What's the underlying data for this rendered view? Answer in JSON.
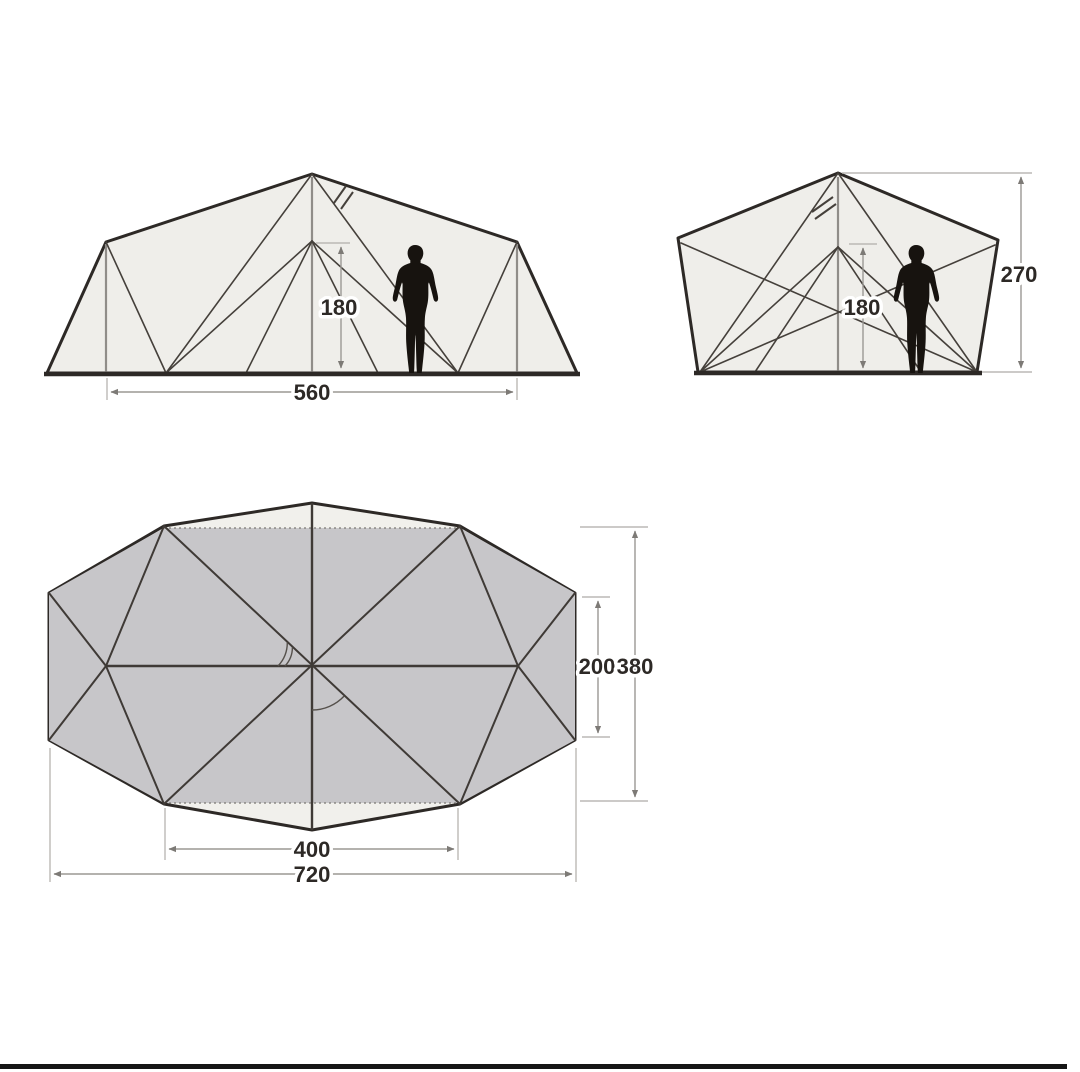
{
  "page": {
    "background": "#ffffff",
    "bottom_bar_color": "#151515"
  },
  "colors": {
    "tent_outline": "#2d2926",
    "frame_line": "#45403b",
    "pole_gray": "#908d89",
    "dimension_line": "#9b9894",
    "label_text": "#2d2926",
    "tent_fill": "#efeeea",
    "plan_outer_fill": "#f1f0ec",
    "plan_inner_fill": "#c7c6c9",
    "silhouette": "#17130f"
  },
  "views": {
    "side": {
      "name": "side-elevation",
      "inner_height_cm": "180",
      "inner_width_cm": "560"
    },
    "end": {
      "name": "end-elevation",
      "inner_height_cm": "180",
      "peak_height_cm": "270"
    },
    "plan": {
      "name": "floor-plan",
      "inner_depth_cm": "200",
      "outer_depth_cm": "380",
      "inner_width_cm": "400",
      "outer_width_cm": "720"
    }
  }
}
